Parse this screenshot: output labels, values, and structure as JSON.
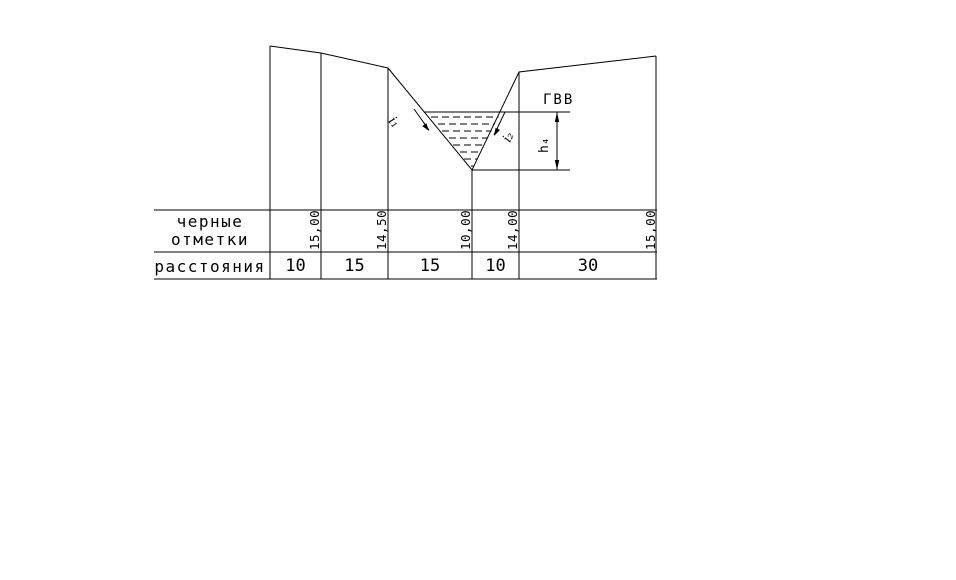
{
  "annotations": {
    "gvv": "ГВВ",
    "depth": "h₄",
    "slope_left": "i₁",
    "slope_right": "i₂"
  },
  "table": {
    "row_labels": {
      "elevations_line1": "черные",
      "elevations_line2": "отметки",
      "distances": "расстояния"
    },
    "elevations": [
      "15,00",
      "14,50",
      "10,00",
      "14,00",
      "15,00"
    ],
    "distances": [
      "10",
      "15",
      "15",
      "10",
      "30"
    ]
  },
  "colors": {
    "ink": "#000000",
    "background": "#ffffff"
  }
}
